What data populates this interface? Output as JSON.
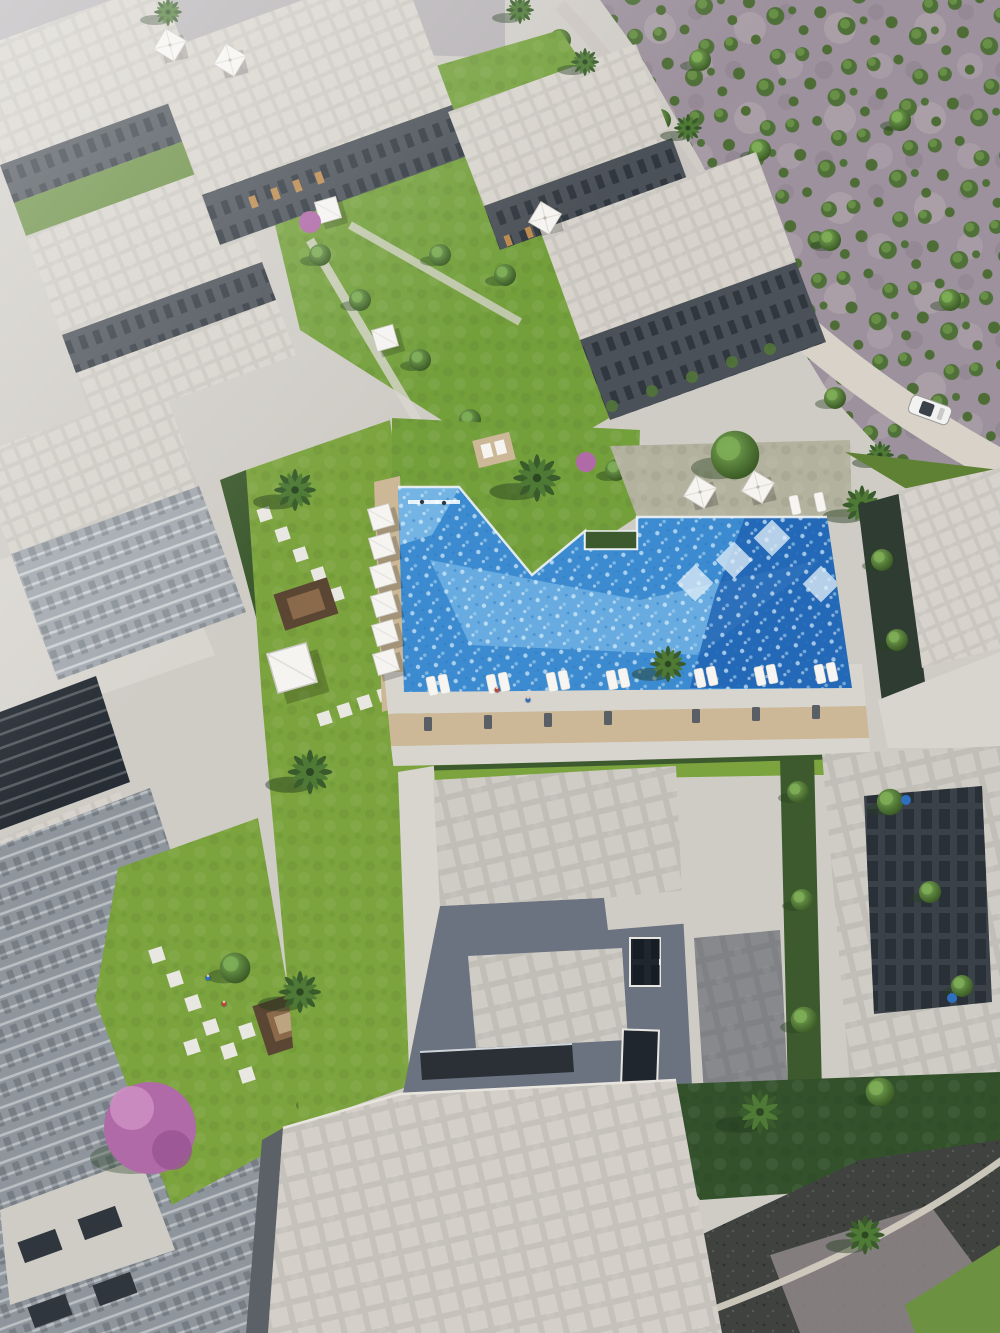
{
  "scene": {
    "title": "aerial-render-residential-compound-with-pool",
    "elements": {
      "pool": "irregular resort swimming pool",
      "desert": "scrub desert with olive shrubs and gravel road",
      "car": "white car on access road",
      "jacaranda": "purple flowering tree",
      "villas": "flat gray villa rooftops",
      "apartments": "apartment blocks with courtyards"
    }
  },
  "colors": {
    "bg_top": "#b6b2b5",
    "concrete": "#cfccc6",
    "deck_pale": "#d8d5cf",
    "roof_light": "#d7d3cc",
    "roof_villa": "#cfccc5",
    "roof_bottom": "#d4d0c9",
    "roof_edge": "#b6b2ab",
    "facade_dark": "#4b5158",
    "facade_mid": "#8e959c",
    "facade_steps": "#a3a9af",
    "glass_dark": "#272d35",
    "slate": "#6b7280",
    "hedge": "#3d5a2f",
    "lawn": "#7ba33e",
    "lawn_pale": "#b3b29e",
    "lawn_dark": "#5e8134",
    "lawn_shade": "#33522c",
    "courtyard": "#74a03c",
    "tree_mid": "#527539",
    "palm_dark": "#2f4d26",
    "desert": "#9c919c",
    "desert_light": "#b7adb2",
    "desert_path": "#d8d2c8",
    "pool": "#3c8bd0",
    "pool_shallow": "#8ac6ec",
    "pool_deep": "#1e60b0",
    "pool_sparkle": "#d9eefb",
    "pool_edge": "#eef3f6",
    "wood": "#ccb897",
    "wood_dark": "#5a4632",
    "rug": "#8a6a4a",
    "white": "#f5f4f1",
    "car_white": "#f2f2f0",
    "car_glass": "#3a4148",
    "car_blue": "#2c4a7c",
    "road_dark": "#3f423f",
    "road_gravel": "#8f8789",
    "curb": "#d2ccc0",
    "purple": "#b06aa8",
    "purple_light": "#cc8ec2",
    "amber": "#c9914e",
    "person_red": "#b34a3c",
    "person_blue": "#2e6fbf"
  }
}
